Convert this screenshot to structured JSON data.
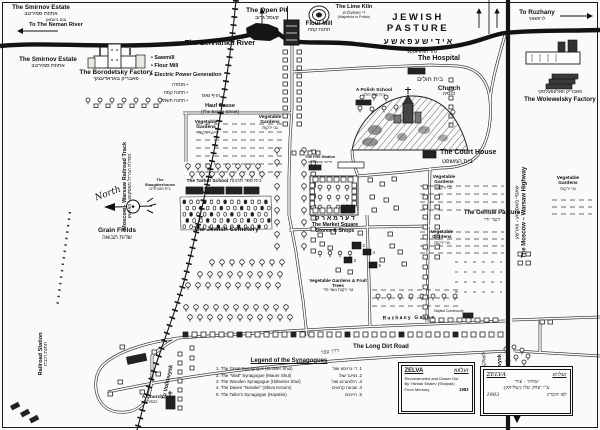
{
  "page": {
    "bg": "#fafaf8",
    "ink": "#1a1a1a"
  },
  "labels": {
    "smirnov_estate_1": {
      "en": "The Smirnov Estate",
      "he": "אחוזת סמירנוב"
    },
    "smirnov_estate_2": {
      "en": "The Smirnov Estate",
      "he": "אחוזת סמירנוב"
    },
    "to_neman_river": {
      "he": "צום ניעמאן",
      "en": "To The Neman River"
    },
    "open_pit": {
      "en": "The Open Pit",
      "he": "קעסל גרוב"
    },
    "flour_mill": {
      "en": "Flour Mill",
      "he": "תחנת קמח"
    },
    "lime_kiln": {
      "en": "The Lime Kiln",
      "he": "די וואפעלניע",
      "sub": "(Wapelnia in Polish)"
    },
    "jewish_pasture": {
      "en": "JEWISH PASTURE",
      "he": "א י ד י ש ע   פ א ש ע"
    },
    "to_ruzhany": {
      "en": "To Ruzhany",
      "he": "לרוזשאני"
    },
    "zelvianka_river": {
      "en": "The Zelvianka River",
      "he": "נהר זעלוויאנקע"
    },
    "borodetsky_factory": {
      "en": "The Borodetsky Factory",
      "he": "פאבריק באראדעצקי"
    },
    "facilities_en": [
      "• Sawmill",
      "• Flour Mill",
      "• Electric Power Generation"
    ],
    "facilities_he": [
      "מנסרה  •",
      "תחנת קמח  •",
      "תחנת חשמל  •"
    ],
    "hospital": {
      "en": "The Hospital",
      "he": "בית חולים"
    },
    "polish_school": {
      "en": "A Polish School",
      "he": "בית ספר פולני"
    },
    "church": {
      "en": "Church",
      "he": "כנסיה"
    },
    "court_house": {
      "en": "The Court House",
      "he": "בית המשפט"
    },
    "wolewelsky_factory": {
      "en": "The Wolewelsky Factory",
      "he": "פאבריק וואלעוועלסקי"
    },
    "railroad_track": {
      "en": "Moscow - Warsaw Railroad Track",
      "he": "מסילת הברזל מאסקווע - ווארשע"
    },
    "north": "North",
    "grain_fields": {
      "en": "Grain Fields",
      "he": "שדות תבואה"
    },
    "hauf_gasse": {
      "he": "הויף גאס",
      "en": "Hauf Gasse",
      "sub": "(The Estate Street)"
    },
    "vegetable_gardens": {
      "en": "Vegetable Gardens",
      "he": "גני ירקות"
    },
    "veg_fruit": {
      "en": "Vegetable Gardens & Fruit Trees",
      "he": "גני ירקות ועצי פרי"
    },
    "slaughterhouse": {
      "en": "The Slaughterhouse",
      "he": "בית מטבחיים"
    },
    "tarbut_school": {
      "en": "The Tarbut School",
      "he": "בית ספר תרבות"
    },
    "jewish_cemetery": {
      "en": "The Jewish Cemetery"
    },
    "fire_station": {
      "en": "The Fire Station",
      "he": "פייער קאמאנדע"
    },
    "market_he": "ד ע ר   מ א ר ק",
    "market_square": {
      "line1": "The Market Square",
      "line2": "Stores & Shops"
    },
    "gentile_pasture": {
      "en": "The Gentile Pasture",
      "he": "דער וויי"
    },
    "highway": {
      "en": "The Moscow – Warsaw Highway",
      "he": "שאסיי מאסקווע - ווארשע"
    },
    "ruzhany_gasse": "Ruzhany  Gasse",
    "long_dirt_road": {
      "en": "The Long Dirt Road",
      "he": "דרך עפר"
    },
    "baptist_community": "Baptist Community",
    "small_church": {
      "en": "A Church",
      "he": "כנסיה"
    },
    "railroad_station": {
      "en": "Railroad Station",
      "he": "תחנת רכבת"
    },
    "to_volkovysk": {
      "en": "To Volkovysk",
      "he": "לוואלקאוויסק"
    }
  },
  "legend": {
    "title": "Legend of the Synagogues",
    "items": [
      {
        "en": "1. The Great Synagogue (Groiser Shul)",
        "he": "1. די גרויסע שול"
      },
      {
        "en": "2. The \"Wall\" Synagogue (Mauer Shul)",
        "he": "2. מויער שול"
      },
      {
        "en": "3. The Wooden Synagogue (Hiltsener Shul)",
        "he": "3. הילצערנע שול"
      },
      {
        "en": "4. The Daves \"Noseke\" (Shiva Keruim)",
        "he": "4. שבעה קרואים"
      },
      {
        "en": "5. The Tailor's Synagogue (Hayatim)",
        "he": "5. חייטים"
      }
    ]
  },
  "credit_en": {
    "title": "ZELVA",
    "title_he": "זעלווא",
    "line1": "Reconstructed and Drawn Out",
    "line2": "By Yitzhak Shalev (Shulyak)",
    "line3": "From Memory",
    "year": "1983"
  },
  "credit_he": {
    "title": "ZELVA",
    "title_he": "זעלווא",
    "line1": "שוחזר - צויר",
    "line2": "ע\"י יצחק שלו (שוליאק)",
    "line3": "לפי הזכרון",
    "year": "1983"
  },
  "markers": {
    "synagogue_numbers": [
      "1",
      "2",
      "3",
      "4",
      "5"
    ]
  }
}
